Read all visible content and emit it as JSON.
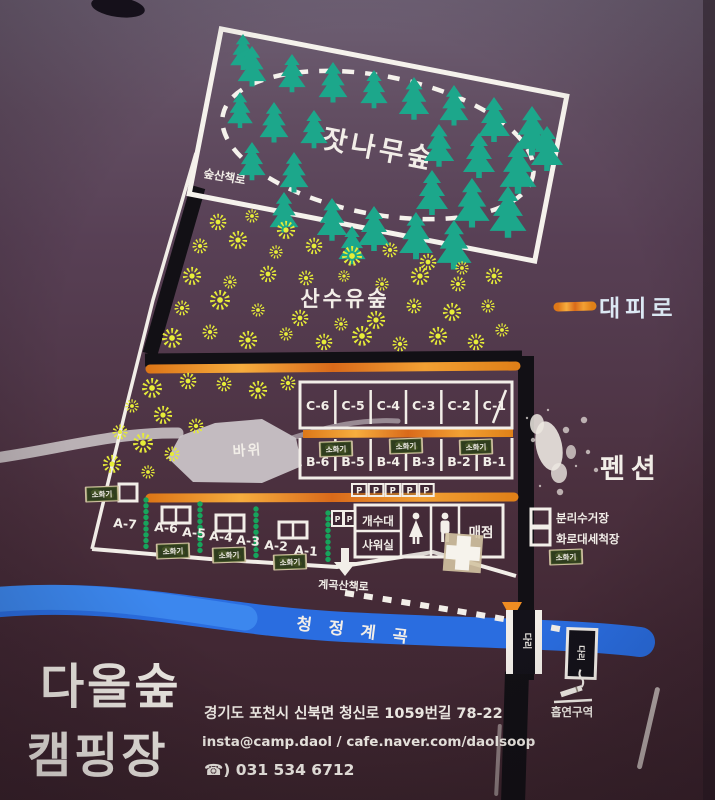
{
  "board": {
    "areas": {
      "pine_forest": "잣나무숲",
      "forest_trail": "숲산책로",
      "sansuyu_forest": "산수유숲",
      "rock": "바위",
      "pension": "펜션",
      "clean_valley": "청정계곡",
      "valley_trail": "계곡산책로"
    },
    "legend": {
      "evacuation_route": "대피로"
    },
    "sites": {
      "c_row": [
        "C-6",
        "C-5",
        "C-4",
        "C-3",
        "C-2",
        "C-1"
      ],
      "b_row": [
        "B-6",
        "B-5",
        "B-4",
        "B-3",
        "B-2",
        "B-1"
      ],
      "a_row": [
        "A-7",
        "A-6",
        "A-5",
        "A-4",
        "A-3",
        "A-2",
        "A-1"
      ]
    },
    "markers": {
      "parking": "P",
      "fire_extinguisher": "소화기",
      "bridge": "다리",
      "smoking_area": "흡연구역"
    },
    "facilities": {
      "sink": "개수대",
      "shower": "샤워실",
      "store": "매점",
      "recycling": "분리수거장",
      "grill_washing": "화로대세척장"
    },
    "footer": {
      "title_line1": "다올숲",
      "title_line2": "캠핑장",
      "address": "경기도 포천시 신북면 청신로 1059번길 78-22",
      "contact": "insta@camp.daol / cafe.naver.com/daolsoop",
      "phone": "☎) 031 534 6712"
    },
    "icons": {
      "pine_tree": "pine-tree-icon",
      "flower": "flower-icon",
      "restroom_female": "female-icon",
      "restroom_male": "male-icon",
      "first_aid": "cross-icon",
      "smoking": "cigarette-icon"
    },
    "colors": {
      "board_top": "#6e6074",
      "board_bottom": "#3a232c",
      "road_orange": "#ef9a2e",
      "road_black": "#121015",
      "river_blue": "#2a6de0",
      "tree_teal": "#1ca78b",
      "flower_yellow": "#e6ec38",
      "hedge_green": "#17a45c",
      "line_white": "#f2eee8"
    }
  }
}
